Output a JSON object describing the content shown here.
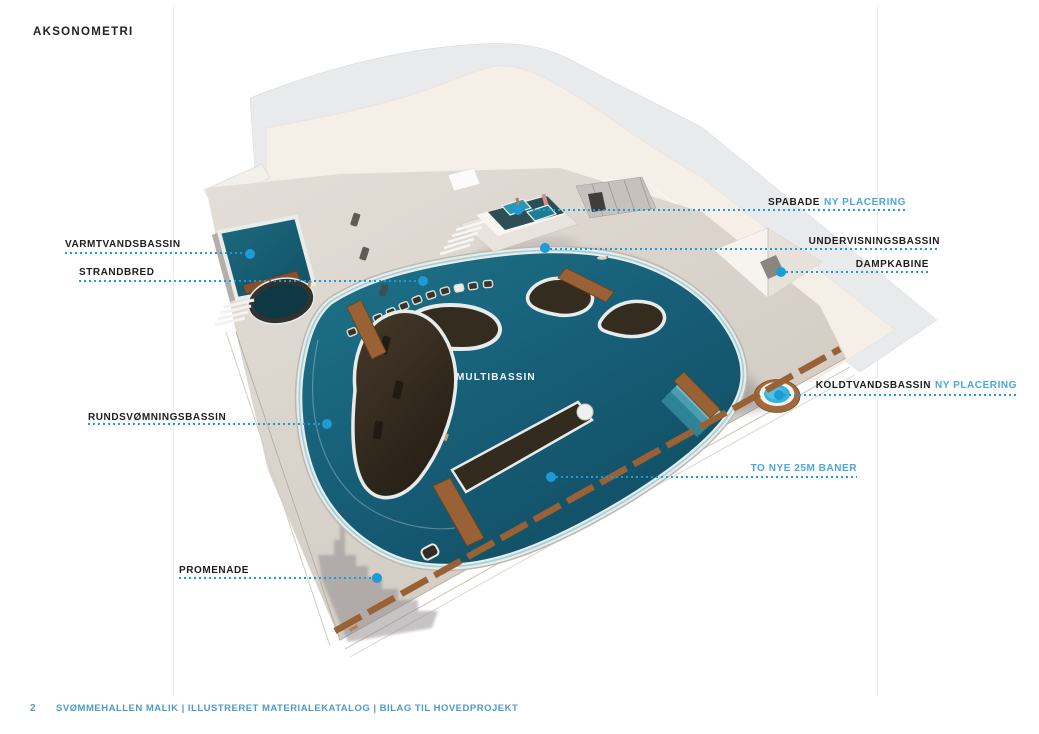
{
  "page": {
    "title": "AKSONOMETRI",
    "footer": {
      "page_number": "2",
      "text": "SVØMMEHALLEN MALIK  |  ILLUSTRERET  MATERIALEKATALOG  |  BILAG TIL HOVEDPROJEKT"
    }
  },
  "theme": {
    "accent_blue": "#1E9AD6",
    "label_blue": "#4BA6DC",
    "label_black": "#201D1C",
    "footer_blue": "#4E9BC8",
    "pool_teal": "#176079",
    "pool_deep": "#114C61",
    "floor_beige": "#D9D3CB",
    "wall_cream": "#F6EFE7",
    "shell_gray": "#E9EAEC",
    "wall_white": "#FBF9F6",
    "wood_brown": "#9A6234",
    "pier_dark": "#352C20"
  },
  "labels": {
    "pool_label": "MULTIBASSIN",
    "callouts": [
      {
        "id": "varmtvandsbassin",
        "text": "VARMTVANDSBASSIN"
      },
      {
        "id": "strandbred",
        "text": "STRANDBRED"
      },
      {
        "id": "rundsvomningsbassin",
        "text": "RUNDSVØMNINGSBASSIN"
      },
      {
        "id": "promenade",
        "text": "PROMENADE"
      },
      {
        "id": "spabade",
        "text": "SPABADE",
        "suffix": "NY PLACERING"
      },
      {
        "id": "undervisningsbassin",
        "text": "UNDERVISNINGSBASSIN"
      },
      {
        "id": "dampkabine",
        "text": "DAMPKABINE"
      },
      {
        "id": "koldtvandsbassin",
        "text": "KOLDTVANDSBASSIN",
        "suffix": "NY PLACERING"
      },
      {
        "id": "to_nye_25m_baner",
        "text": "TO NYE 25M BANER"
      }
    ]
  }
}
